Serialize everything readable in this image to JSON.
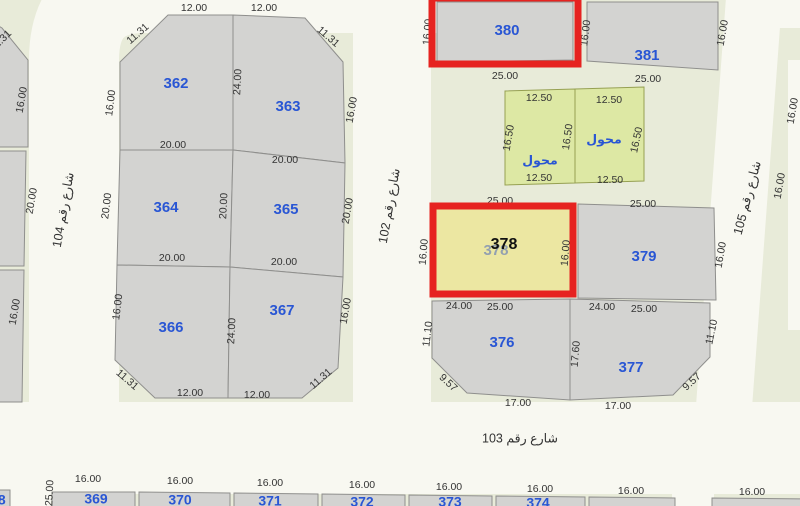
{
  "canvas": {
    "width": 800,
    "height": 506
  },
  "palette": {
    "background": "#e8ebd9",
    "street": "#f8f8f1",
    "parcel_gray": "#d3d3d1",
    "parcel_stroke": "#8f8f8d",
    "parcel_green": "#dde8a4",
    "green_stroke": "#96a052",
    "parcel_yellow": "#ece7a2",
    "highlight_red": "#e62320",
    "number_blue": "#2956d4",
    "dim_text": "#333333",
    "street_text": "#333333",
    "faded_number": "#93a0b0",
    "annotation_black": "#111111"
  },
  "streets": {
    "paths": [
      {
        "name": "street-104-band",
        "d": "M 74,433 V 60 Q 74,-12 145,-12 H 452",
        "width": 90
      },
      {
        "name": "street-102-band",
        "d": "M 392,-25 V 436",
        "width": 78
      },
      {
        "name": "street-103-band",
        "d": "M -25,448 H 825",
        "width": 92
      },
      {
        "name": "street-105-band",
        "d": "M 755,-15 L 722,434",
        "width": 56
      },
      {
        "name": "street-top-right-branch",
        "d": "M 765,5 H 830",
        "width": 46
      },
      {
        "name": "street-right-edge",
        "d": "M 797,60 V 330",
        "width": 18
      },
      {
        "name": "street-stub-left",
        "d": "M 30,458 V 520",
        "width": 42
      },
      {
        "name": "street-stub-right",
        "d": "M 693,452 V 520",
        "width": 42
      }
    ],
    "labels": [
      {
        "text": "شارع رقم 104",
        "x": 64,
        "y": 210,
        "rot": -80
      },
      {
        "text": "شارع رقم 102",
        "x": 390,
        "y": 206,
        "rot": -80
      },
      {
        "text": "شارع رقم 105",
        "x": 748,
        "y": 198,
        "rot": -75
      },
      {
        "text": "شارع رقم 103",
        "x": 520,
        "y": 439,
        "rot": 0
      }
    ]
  },
  "parcels": [
    {
      "number": "362",
      "fill": "gray",
      "points": "120,62 168,15 233,15 233,150 120,150",
      "lx": 176,
      "ly": 84
    },
    {
      "number": "363",
      "fill": "gray",
      "points": "233,15 305,18 343,62 345,163 233,150",
      "lx": 288,
      "ly": 107
    },
    {
      "number": "364",
      "fill": "gray",
      "points": "120,150 233,150 230,267 117,265",
      "lx": 166,
      "ly": 208
    },
    {
      "number": "365",
      "fill": "gray",
      "points": "233,150 345,163 343,277 230,267",
      "lx": 286,
      "ly": 210
    },
    {
      "number": "366",
      "fill": "gray",
      "points": "117,265 230,267 228,398 155,398 115,360",
      "lx": 171,
      "ly": 328
    },
    {
      "number": "367",
      "fill": "gray",
      "points": "230,267 343,277 338,368 302,398 228,398",
      "lx": 282,
      "ly": 311
    },
    {
      "number": "380",
      "fill": "gray",
      "points": "437,2 573,2 573,60 437,62",
      "lx": 507,
      "ly": 31
    },
    {
      "number": "381",
      "fill": "gray",
      "points": "587,2 718,2 718,70 587,61",
      "lx": 647,
      "ly": 56
    },
    {
      "number": "محول",
      "fill": "green",
      "points": "505,91 575,89 575,183 505,185",
      "lx": 540,
      "ly": 161
    },
    {
      "number": "محول",
      "fill": "green",
      "points": "575,89 644,87 644,181 575,183",
      "lx": 604,
      "ly": 140
    },
    {
      "number": "378",
      "fill": "yellow",
      "faded": true,
      "points": "436,207 573,204 573,293 436,296",
      "lx": 496,
      "ly": 251
    },
    {
      "number": "379",
      "fill": "gray",
      "points": "578,204 714,208 716,300 578,298",
      "lx": 644,
      "ly": 257
    },
    {
      "number": "376",
      "fill": "gray",
      "points": "432,301 570,299 570,400 467,393 432,358",
      "lx": 502,
      "ly": 343
    },
    {
      "number": "377",
      "fill": "gray",
      "points": "570,299 710,303 710,357 673,395 570,400",
      "lx": 631,
      "ly": 368
    },
    {
      "number": "368",
      "fill": "gray",
      "points": "-12,490 10,490 10,516 -12,516",
      "lx": -6,
      "ly": 501
    },
    {
      "number": "369",
      "fill": "gray",
      "points": "52,492 135,492 135,516 52,516",
      "lx": 96,
      "ly": 500
    },
    {
      "number": "370",
      "fill": "gray",
      "points": "139,492 230,493 230,516 139,516",
      "lx": 180,
      "ly": 501
    },
    {
      "number": "371",
      "fill": "gray",
      "points": "234,493 318,494 318,516 234,516",
      "lx": 270,
      "ly": 502
    },
    {
      "number": "372",
      "fill": "gray",
      "points": "322,494 405,495 405,516 322,516",
      "lx": 362,
      "ly": 503
    },
    {
      "number": "373",
      "fill": "gray",
      "points": "409,495 492,496 492,516 409,516",
      "lx": 450,
      "ly": 503
    },
    {
      "number": "374",
      "fill": "gray",
      "points": "496,496 585,497 585,516 496,516",
      "lx": 538,
      "ly": 504
    },
    {
      "number": "",
      "fill": "gray",
      "points": "589,497 675,498 675,516 589,516",
      "lx": 630,
      "ly": 510
    },
    {
      "number": "",
      "fill": "gray",
      "points": "712,498 810,499 810,516 712,516",
      "lx": 758,
      "ly": 512
    },
    {
      "number": "",
      "fill": "gray",
      "points": "-12,20 2,28 28,60 28,147 -12,147",
      "lx": -20,
      "ly": 100
    },
    {
      "number": "",
      "fill": "gray",
      "points": "-12,151 26,151 24,266 -12,266",
      "lx": -20,
      "ly": 200
    },
    {
      "number": "",
      "fill": "gray",
      "points": "-12,270 24,270 22,402 -12,402",
      "lx": -20,
      "ly": 330
    }
  ],
  "dimensions": [
    {
      "t": "12.00",
      "x": 194,
      "y": 8,
      "r": 0
    },
    {
      "t": "12.00",
      "x": 264,
      "y": 8,
      "r": 0
    },
    {
      "t": "11.31",
      "x": 138,
      "y": 34,
      "r": -41
    },
    {
      "t": "11.31",
      "x": 328,
      "y": 37,
      "r": 41
    },
    {
      "t": "16.00",
      "x": 111,
      "y": 103,
      "r": -83
    },
    {
      "t": "24.00",
      "x": 238,
      "y": 82,
      "r": -87
    },
    {
      "t": "16.00",
      "x": 352,
      "y": 110,
      "r": -80
    },
    {
      "t": "20.00",
      "x": 173,
      "y": 145,
      "r": 0
    },
    {
      "t": "20.00",
      "x": 285,
      "y": 160,
      "r": 0
    },
    {
      "t": "20.00",
      "x": 107,
      "y": 206,
      "r": -83
    },
    {
      "t": "20.00",
      "x": 224,
      "y": 206,
      "r": -87
    },
    {
      "t": "20.00",
      "x": 348,
      "y": 211,
      "r": -80
    },
    {
      "t": "20.00",
      "x": 172,
      "y": 258,
      "r": 0
    },
    {
      "t": "20.00",
      "x": 284,
      "y": 262,
      "r": 0
    },
    {
      "t": "16.00",
      "x": 118,
      "y": 307,
      "r": -83
    },
    {
      "t": "24.00",
      "x": 232,
      "y": 331,
      "r": -87
    },
    {
      "t": "16.00",
      "x": 346,
      "y": 311,
      "r": -80
    },
    {
      "t": "11.31",
      "x": 127,
      "y": 380,
      "r": 41
    },
    {
      "t": "11.31",
      "x": 321,
      "y": 379,
      "r": -41
    },
    {
      "t": "12.00",
      "x": 190,
      "y": 393,
      "r": 0
    },
    {
      "t": "12.00",
      "x": 257,
      "y": 395,
      "r": 0
    },
    {
      "t": "11.31",
      "x": 1,
      "y": 41,
      "r": -45
    },
    {
      "t": "16.00",
      "x": 22,
      "y": 100,
      "r": -80
    },
    {
      "t": "20.00",
      "x": 32,
      "y": 201,
      "r": -80
    },
    {
      "t": "16.00",
      "x": 15,
      "y": 312,
      "r": -80
    },
    {
      "t": "16.00",
      "x": 428,
      "y": 32,
      "r": -85
    },
    {
      "t": "16.00",
      "x": 586,
      "y": 33,
      "r": -83
    },
    {
      "t": "16.00",
      "x": 723,
      "y": 33,
      "r": -80
    },
    {
      "t": "25.00",
      "x": 505,
      "y": 76,
      "r": 0
    },
    {
      "t": "25.00",
      "x": 648,
      "y": 79,
      "r": 0
    },
    {
      "t": "12.50",
      "x": 539,
      "y": 98,
      "r": 0
    },
    {
      "t": "12.50",
      "x": 609,
      "y": 100,
      "r": 0
    },
    {
      "t": "16.50",
      "x": 509,
      "y": 138,
      "r": -80
    },
    {
      "t": "16.50",
      "x": 568,
      "y": 137,
      "r": -82
    },
    {
      "t": "16.50",
      "x": 637,
      "y": 140,
      "r": -78
    },
    {
      "t": "12.50",
      "x": 539,
      "y": 178,
      "r": 0
    },
    {
      "t": "12.50",
      "x": 610,
      "y": 180,
      "r": 0
    },
    {
      "t": "25.00",
      "x": 500,
      "y": 201,
      "r": 0
    },
    {
      "t": "25.00",
      "x": 643,
      "y": 204,
      "r": 0
    },
    {
      "t": "16.00",
      "x": 424,
      "y": 252,
      "r": -85
    },
    {
      "t": "16.00",
      "x": 566,
      "y": 253,
      "r": -85
    },
    {
      "t": "16.00",
      "x": 721,
      "y": 255,
      "r": -80
    },
    {
      "t": "24.00",
      "x": 459,
      "y": 306,
      "r": 0
    },
    {
      "t": "25.00",
      "x": 500,
      "y": 307,
      "r": 0
    },
    {
      "t": "24.00",
      "x": 602,
      "y": 307,
      "r": 0
    },
    {
      "t": "25.00",
      "x": 644,
      "y": 309,
      "r": 0
    },
    {
      "t": "11.10",
      "x": 428,
      "y": 334,
      "r": -83
    },
    {
      "t": "17.60",
      "x": 576,
      "y": 354,
      "r": -85
    },
    {
      "t": "11.10",
      "x": 712,
      "y": 332,
      "r": -78
    },
    {
      "t": "9.57",
      "x": 448,
      "y": 383,
      "r": 43
    },
    {
      "t": "9.57",
      "x": 692,
      "y": 382,
      "r": -43
    },
    {
      "t": "17.00",
      "x": 518,
      "y": 403,
      "r": 0
    },
    {
      "t": "17.00",
      "x": 618,
      "y": 406,
      "r": 0
    },
    {
      "t": "16.00",
      "x": 793,
      "y": 111,
      "r": -80
    },
    {
      "t": "16.00",
      "x": 780,
      "y": 186,
      "r": -80
    },
    {
      "t": "25.00",
      "x": 50,
      "y": 493,
      "r": -87
    },
    {
      "t": "16.00",
      "x": 88,
      "y": 479,
      "r": 0
    },
    {
      "t": "16.00",
      "x": 180,
      "y": 481,
      "r": 0
    },
    {
      "t": "16.00",
      "x": 270,
      "y": 483,
      "r": 0
    },
    {
      "t": "16.00",
      "x": 362,
      "y": 485,
      "r": 0
    },
    {
      "t": "16.00",
      "x": 449,
      "y": 487,
      "r": 0
    },
    {
      "t": "16.00",
      "x": 540,
      "y": 489,
      "r": 0
    },
    {
      "t": "16.00",
      "x": 631,
      "y": 491,
      "r": 0
    },
    {
      "t": "16.00",
      "x": 752,
      "y": 492,
      "r": 0
    }
  ],
  "highlights": [
    {
      "name": "highlight-parcel-380",
      "x": 432,
      "y": -2,
      "w": 146,
      "h": 66
    },
    {
      "name": "highlight-parcel-378",
      "x": 433,
      "y": 206,
      "w": 140,
      "h": 88
    }
  ],
  "annotation": {
    "text": "378",
    "x": 504,
    "y": 245
  }
}
